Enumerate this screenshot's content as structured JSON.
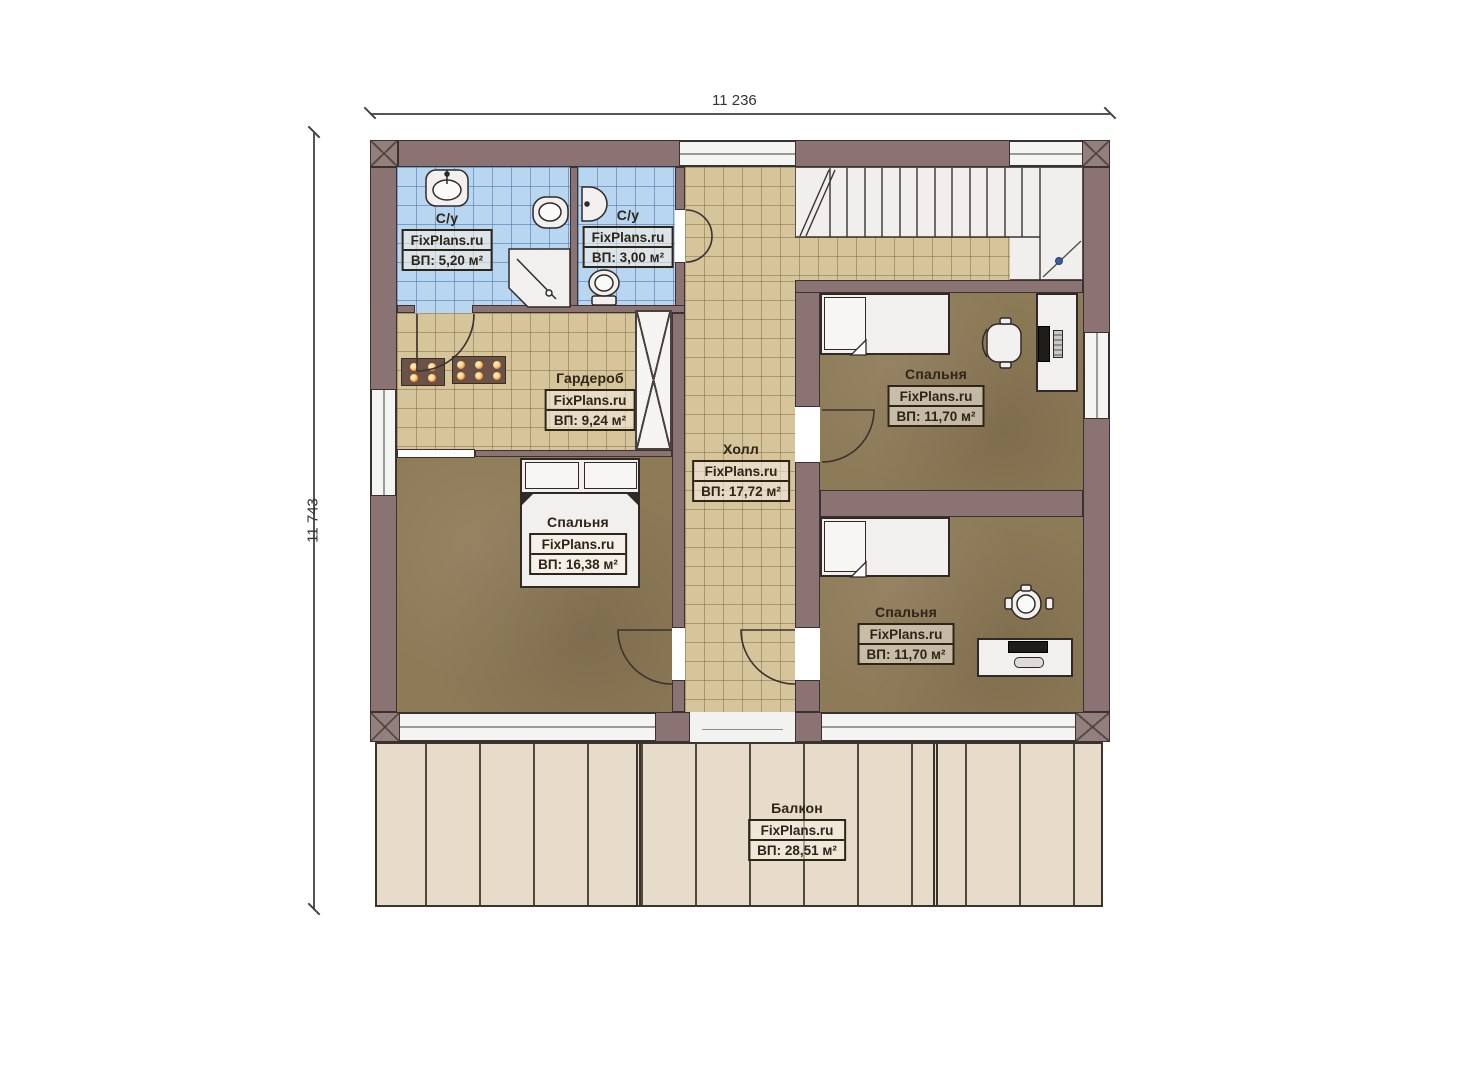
{
  "dimensions": {
    "width_label": "11 236",
    "height_label": "11 743"
  },
  "rooms": [
    {
      "id": "bathroom-1",
      "name": "С/у",
      "brand": "FixPlans.ru",
      "area": "ВП: 5,20 м²"
    },
    {
      "id": "bathroom-2",
      "name": "С/у",
      "brand": "FixPlans.ru",
      "area": "ВП: 3,00 м²"
    },
    {
      "id": "wardrobe",
      "name": "Гардероб",
      "brand": "FixPlans.ru",
      "area": "ВП: 9,24 м²"
    },
    {
      "id": "hall",
      "name": "Холл",
      "brand": "FixPlans.ru",
      "area": "ВП: 17,72 м²"
    },
    {
      "id": "bedroom-master",
      "name": "Спальня",
      "brand": "FixPlans.ru",
      "area": "ВП: 16,38 м²"
    },
    {
      "id": "bedroom-top-right",
      "name": "Спальня",
      "brand": "FixPlans.ru",
      "area": "ВП: 11,70 м²"
    },
    {
      "id": "bedroom-bottom-right",
      "name": "Спальня",
      "brand": "FixPlans.ru",
      "area": "ВП: 11,70 м²"
    },
    {
      "id": "balcony",
      "name": "Балкон",
      "brand": "FixPlans.ru",
      "area": "ВП: 28,51 м²"
    }
  ],
  "icons": [
    "sink-icon",
    "toilet-icon",
    "shower-icon",
    "office-chair-icon",
    "stool-chair-icon",
    "stairs",
    "walk-line-dot"
  ],
  "colors": {
    "wall": "#8b7373",
    "wall-edge": "#3a3231",
    "tile-blue": "#b9d6f0",
    "tile-blue-line": "#6f9bcd",
    "tile-tan": "#d6c49b",
    "tile-tan-line": "#a08c5f",
    "floor-brown": "#8d7a57",
    "balcony-floor": "#e7dcc9",
    "fixture-white": "#f1f0ee",
    "accent-orange": "#ff9d3c",
    "walkline-blue": "#3b5f9d",
    "label-ink": "#2e2418"
  }
}
